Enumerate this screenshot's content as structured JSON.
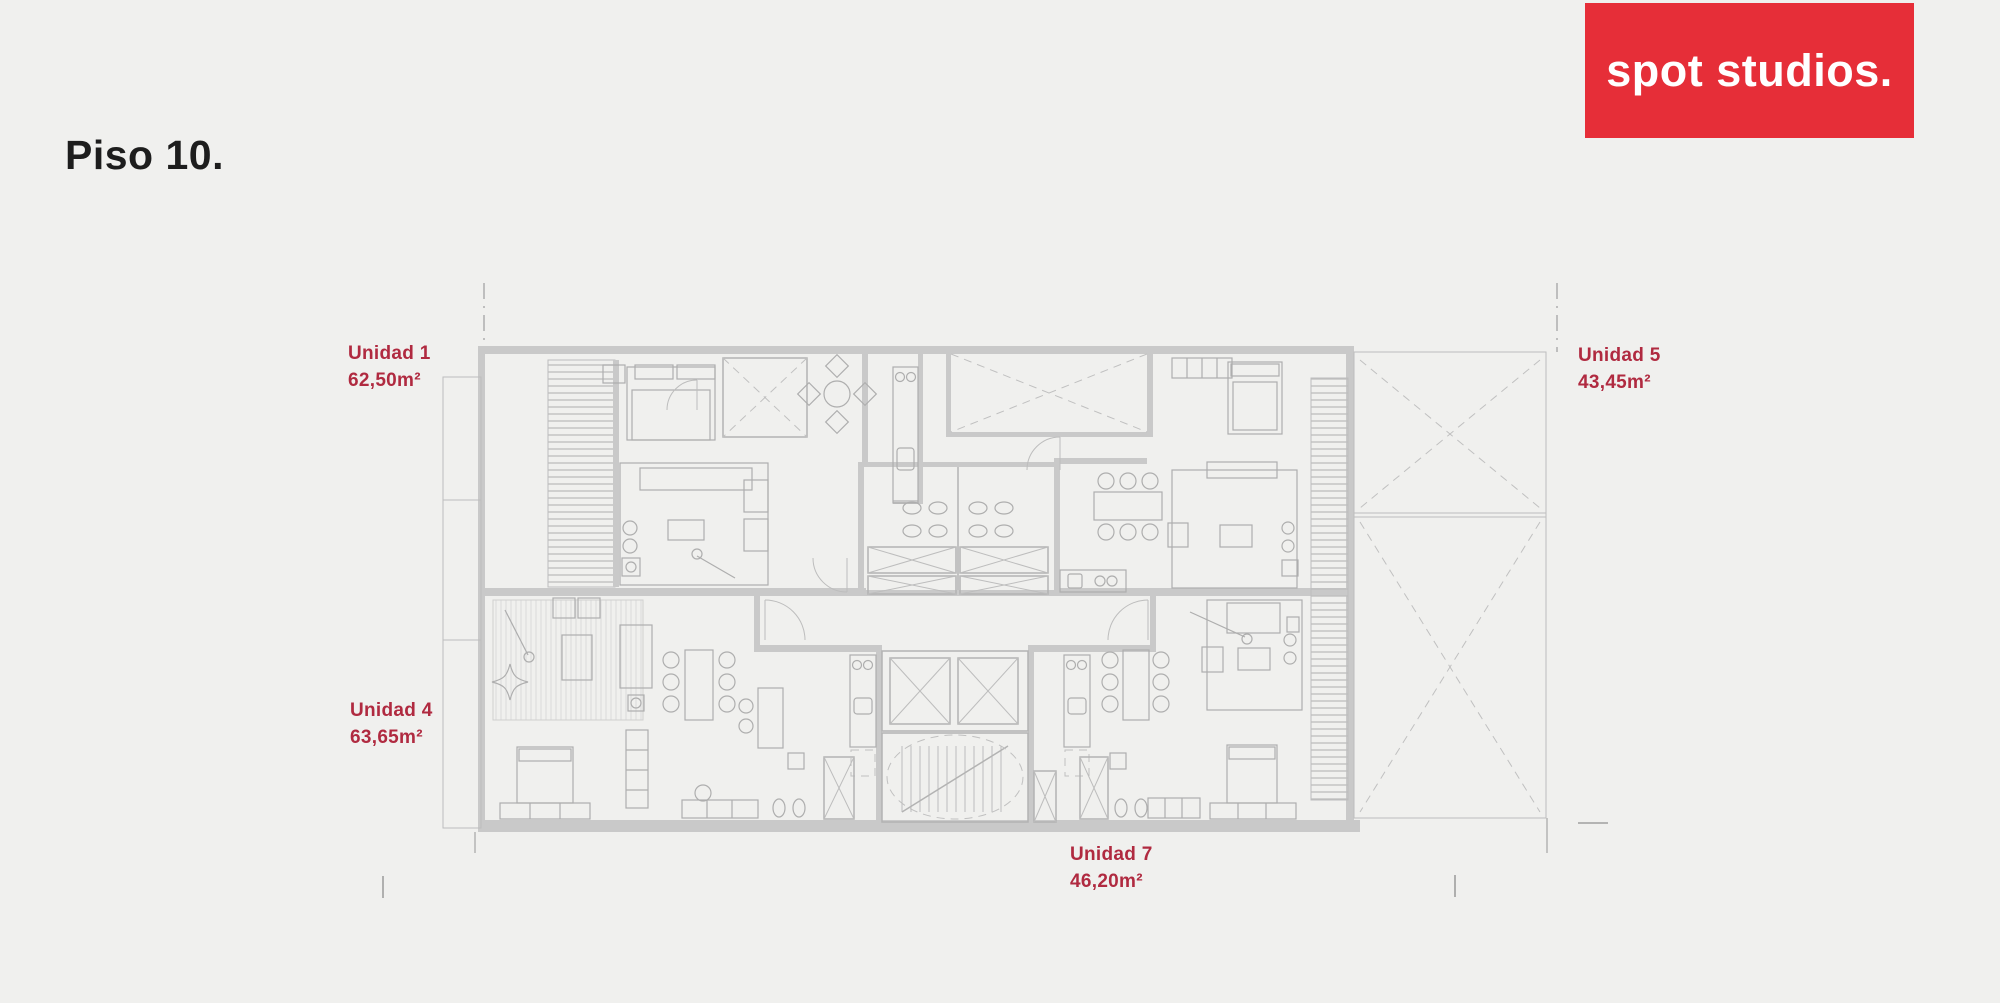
{
  "title": "Piso 10.",
  "logo": {
    "text": "spot studios.",
    "background": "#e62e38",
    "text_color": "#ffffff"
  },
  "units": {
    "unidad1": {
      "name": "Unidad 1",
      "area": "62,50m²"
    },
    "unidad5": {
      "name": "Unidad 5",
      "area": "43,45m²"
    },
    "unidad4": {
      "name": "Unidad 4",
      "area": "63,65m²"
    },
    "unidad7": {
      "name": "Unidad 7",
      "area": "46,20m²"
    }
  },
  "colors": {
    "background": "#f0f0ee",
    "plan_wall": "#c9c9c9",
    "plan_line": "#b3b3b3",
    "label_red": "#b02a40",
    "title_color": "#1d1d1d",
    "logo_red": "#e62e38"
  }
}
